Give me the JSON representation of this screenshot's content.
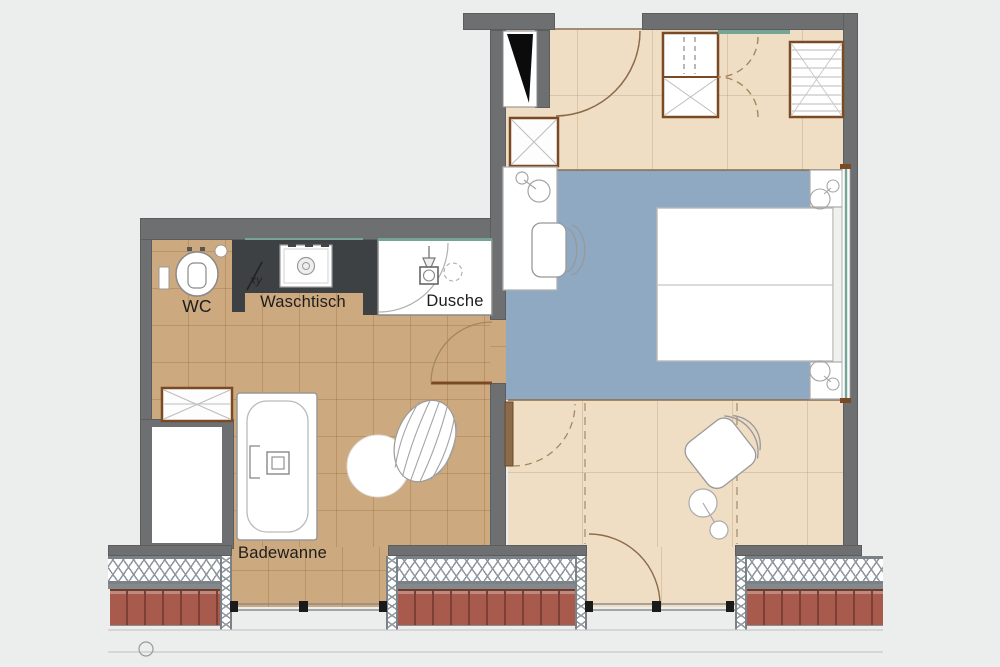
{
  "plan": {
    "type": "hotel room floor plan",
    "labels": {
      "wc": "WC",
      "waschtisch": "Waschtisch",
      "dusche": "Dusche",
      "badewanne": "Badewanne",
      "section_marker": "xy"
    },
    "colors": {
      "bg": "#eceded",
      "wall": "#6e6f70",
      "walledge": "#5c5d5e",
      "tile": "#cda97f",
      "hall": "#efddc4",
      "carpet": "#8fa9c2",
      "counter": "#3e4144",
      "cab": "#7a4a24",
      "arc": "#8b6b4a",
      "dash": "#a3885f",
      "red": "#a85b4c",
      "redline": "#7c4134",
      "teal": "#74a496",
      "insul": "#8e979c",
      "fixture": "#999999",
      "text": "#1d1d1d"
    }
  }
}
